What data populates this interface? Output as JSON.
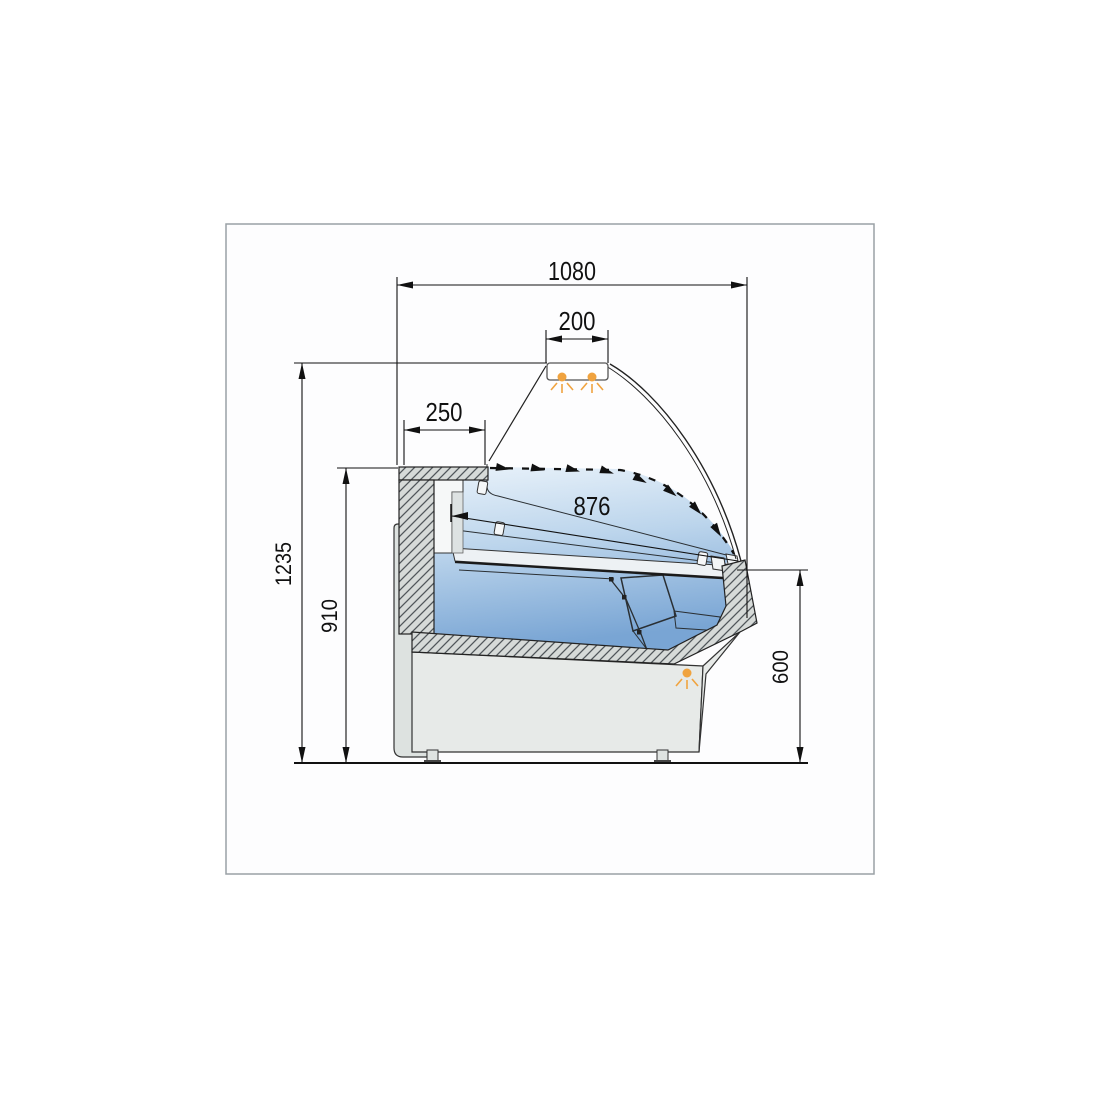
{
  "drawing": {
    "dims": {
      "overall_width": "1080",
      "canopy_width": "200",
      "rear_counter_depth": "250",
      "display_opening": "876",
      "overall_height": "1235",
      "counter_height": "910",
      "front_sill_height": "600"
    },
    "lamps": {
      "canopy_lamp_count": 2,
      "front_lamp_count": 1
    },
    "colors": {
      "line": "#1a1a1a",
      "border": "#9aa1a5",
      "hatch_fill": "#d6dad8",
      "hatch_line": "#50565a",
      "panel": "#e7eae8",
      "panel_dark": "#dde2e0",
      "glass_top": "#e9f2fa",
      "glass_mid": "#bcd5ec",
      "glass_bottom": "#79a5d4",
      "lamp": "#f0a33f",
      "deck": "#edf1f4"
    }
  }
}
